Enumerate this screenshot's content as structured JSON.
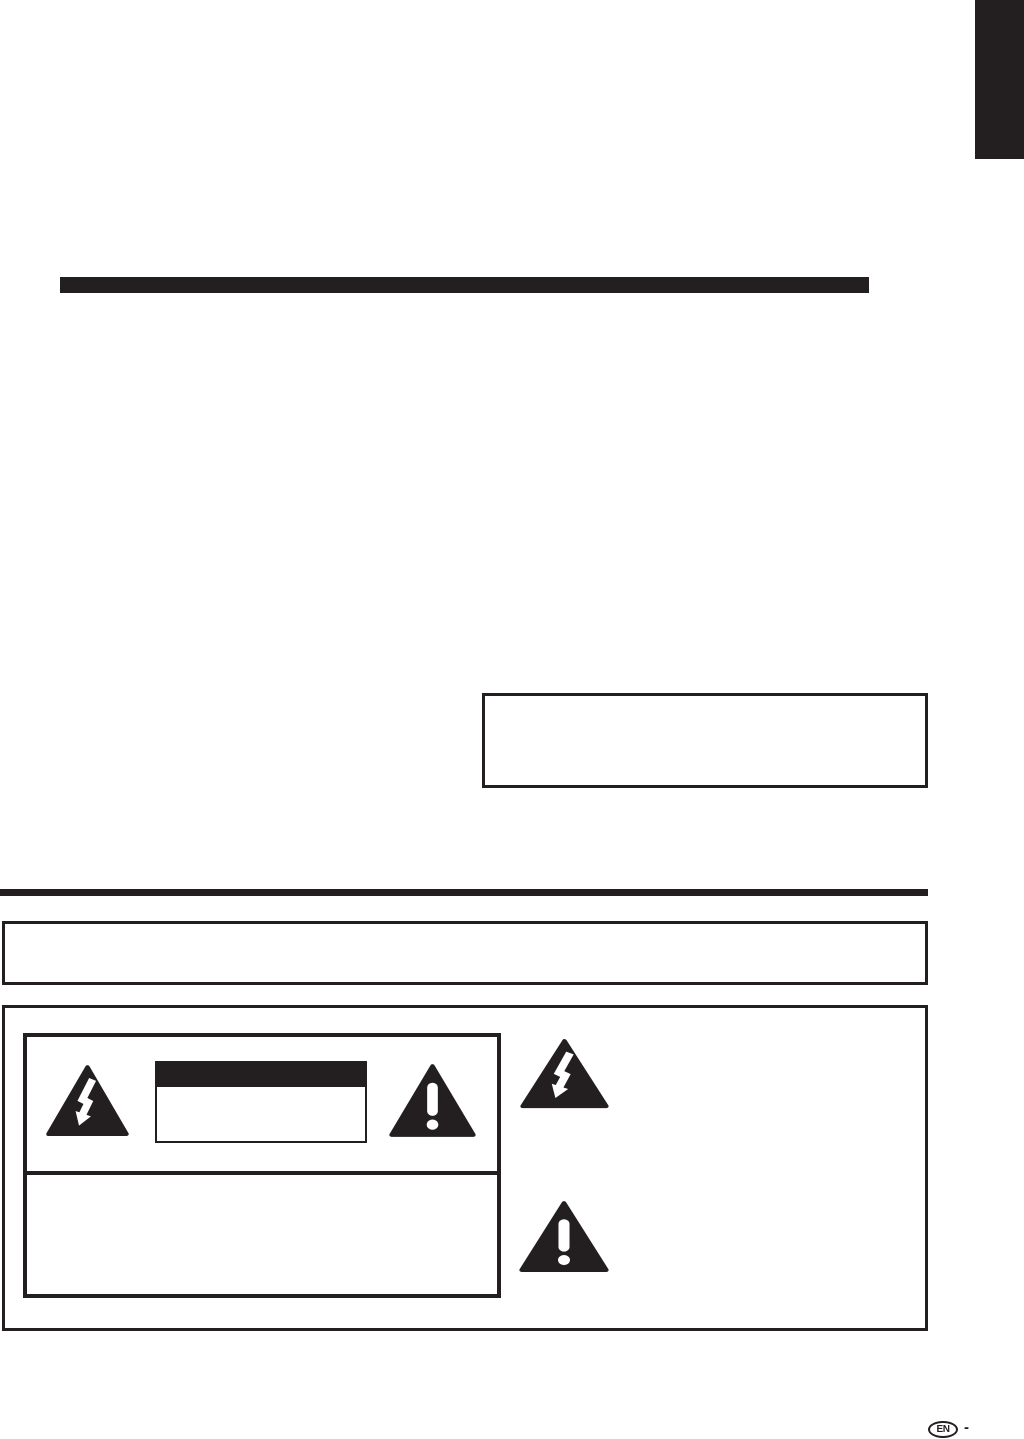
{
  "page": {
    "kind": "manual-safety-page",
    "background_color": "#ffffff",
    "ink_color": "#231f20"
  },
  "header": {
    "corner_tab": "black page-edge tab (top right)",
    "title_rule": "black heading rule"
  },
  "mid": {
    "fcc_box": "empty bordered note box",
    "section_rule": "thick black section rule",
    "note_box": "empty full-width bordered note box"
  },
  "safety_panel": {
    "description": "bordered panel with warning label reproduction and safety symbols",
    "warning_label": {
      "caution_title_bar": "black caution title bar (no legible text)",
      "caution_text_box": "empty bordered caution text box"
    },
    "icons": {
      "lightning_small": "high-voltage-triangle-icon",
      "exclamation_small": "caution-triangle-icon",
      "lightning_large": "high-voltage-triangle-icon",
      "exclamation_large": "caution-triangle-icon"
    }
  },
  "footer": {
    "language_badge": "EN",
    "separator": "-"
  }
}
